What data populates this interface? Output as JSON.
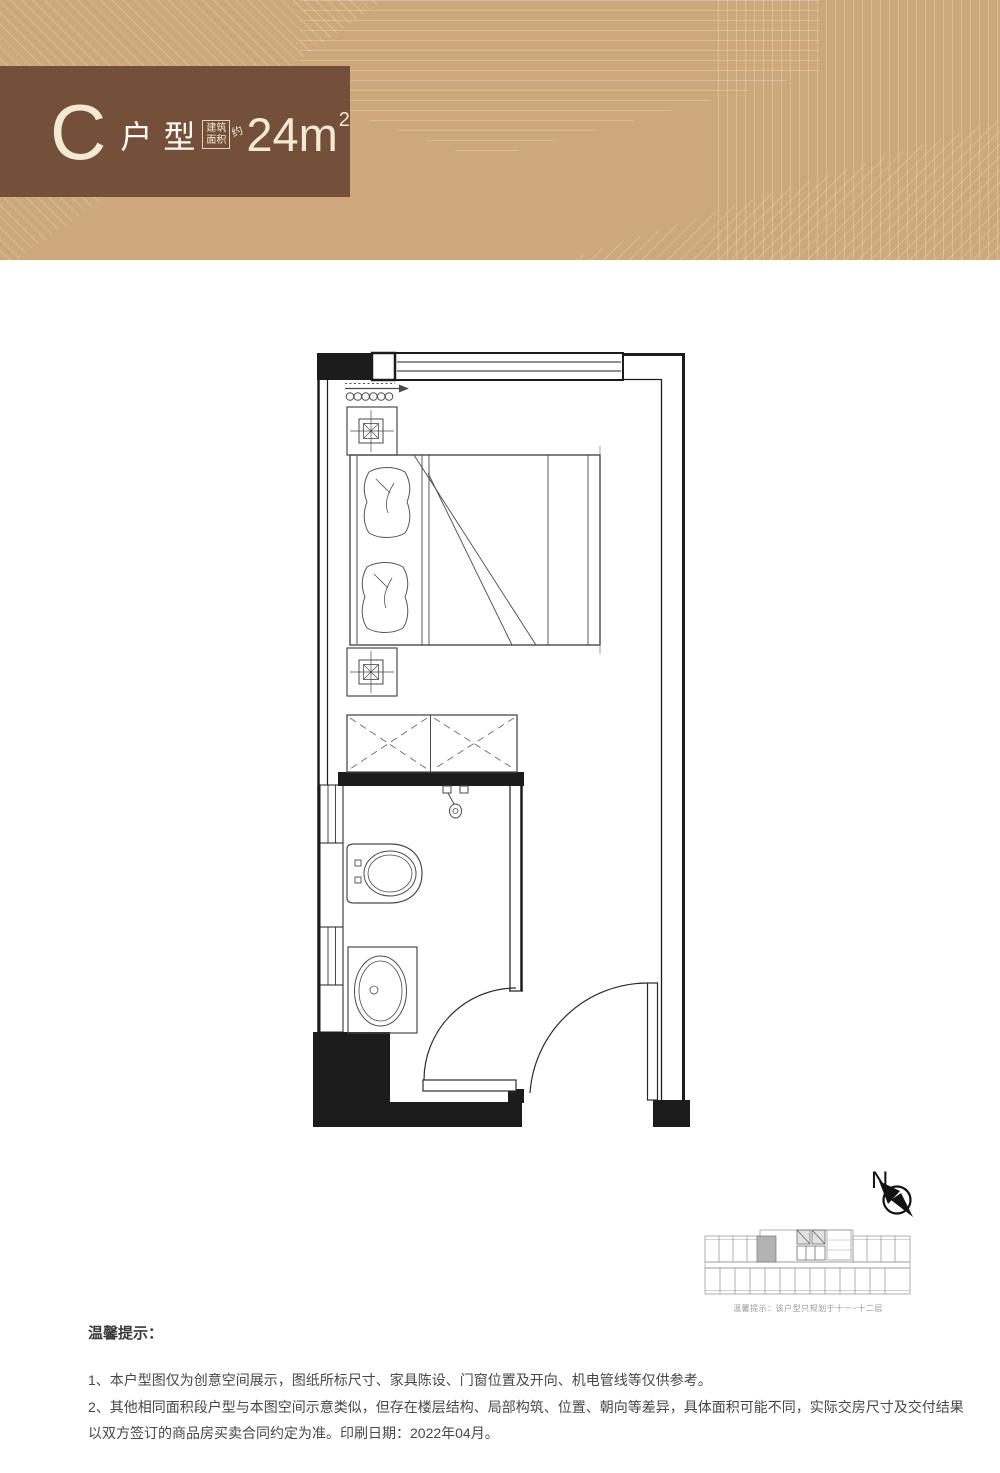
{
  "header": {
    "unit_letter": "C",
    "unit_type": "户型",
    "area_label_line1": "建筑",
    "area_label_line2": "面积",
    "area_approx": "约",
    "area_value": "24m",
    "area_exponent": "2"
  },
  "floor_plan": {
    "elements": [
      "window-strip",
      "wall-column",
      "curtain-arrow",
      "nightstand-lamp",
      "double-bed",
      "pillow",
      "wardrobe",
      "shower-head",
      "toilet",
      "wash-basin",
      "bathroom-door",
      "entry-door"
    ]
  },
  "compass": {
    "letter": "N"
  },
  "key_plan": {
    "caption": "温馨提示：该户型只规划于十一~十二层"
  },
  "notes": {
    "title": "温馨提示：",
    "items": [
      "1、本户型图仅为创意空间展示，图纸所标尺寸、家具陈设、门窗位置及开向、机电管线等仅供参考。",
      "2、其他相同面积段户型与本图空间示意类似，但存在楼层结构、局部构筑、位置、朝向等差异，具体面积可能不同，实际交房尺寸及交付结果以双方签订的商品房买卖合同约定为准。印刷日期：2022年04月。"
    ]
  },
  "colors": {
    "banner_bg": "#cda87c",
    "title_box_bg": "#74503a",
    "title_text": "#f4e9d5",
    "wall_line": "#1c1c1c",
    "furniture_line": "#4a4a4a",
    "keyplan_highlight": "#b3b3b3",
    "note_text": "#474747"
  }
}
